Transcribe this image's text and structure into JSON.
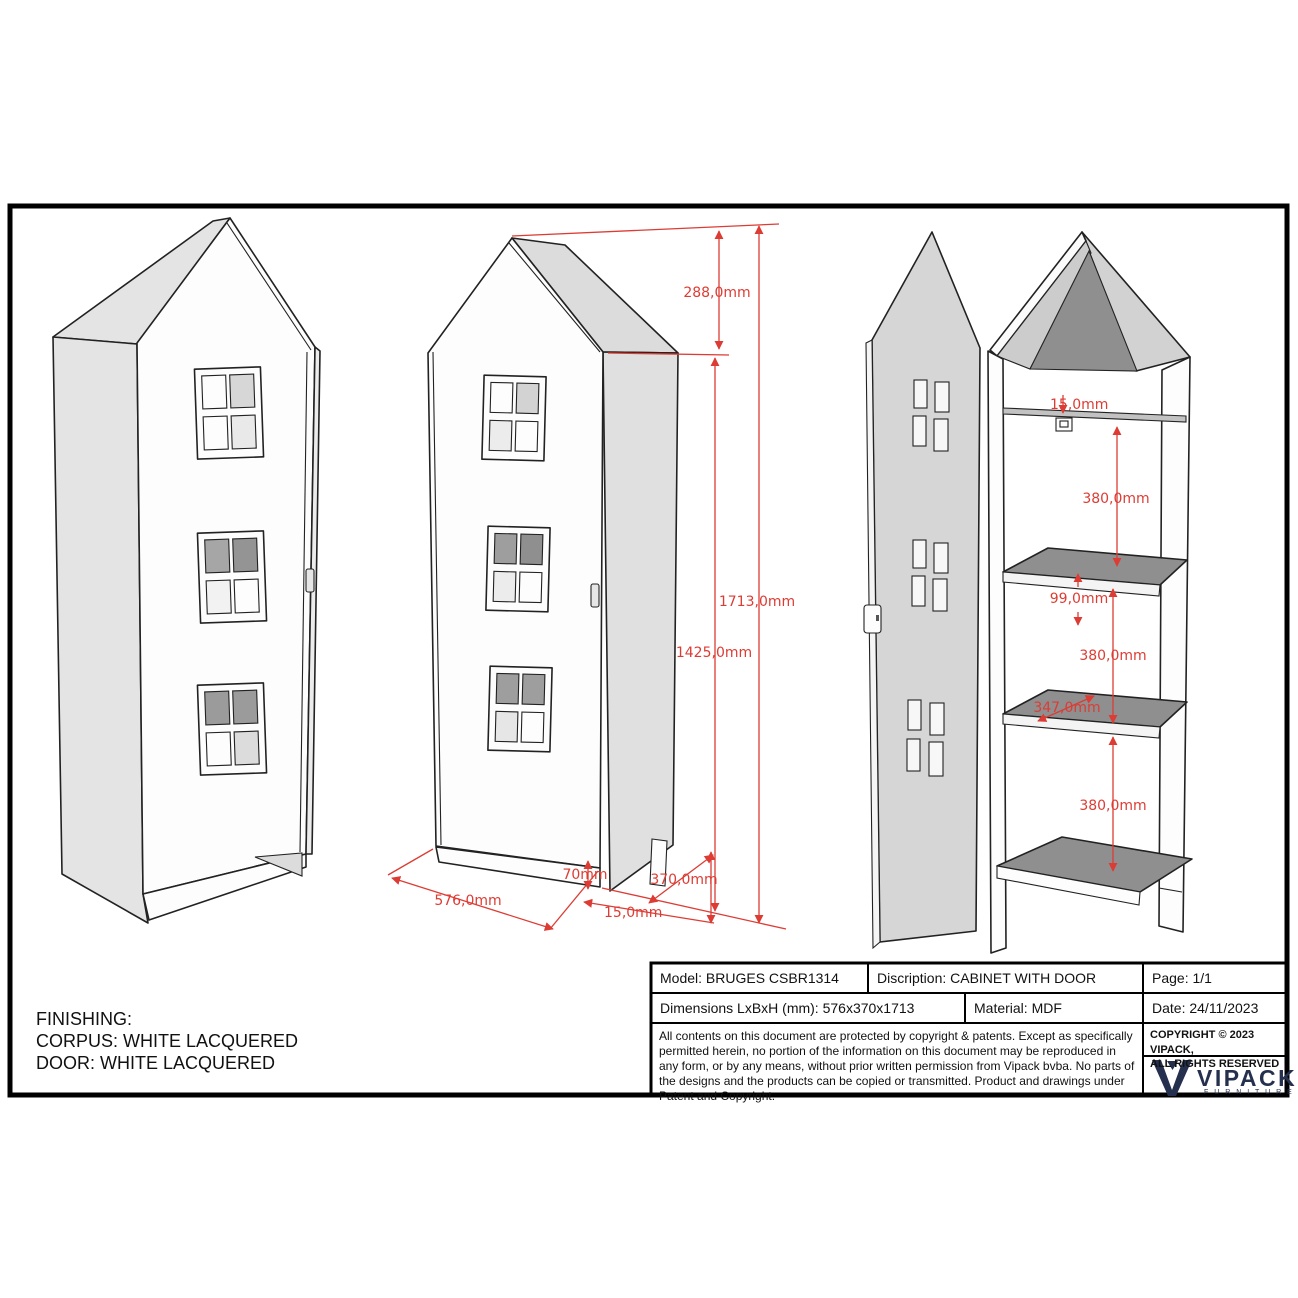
{
  "finishing": {
    "line1": "FINISHING:",
    "line2": "CORPUS: WHITE LACQUERED",
    "line3": "DOOR: WHITE LACQUERED"
  },
  "title_block": {
    "model": "Model: BRUGES CSBR1314",
    "description": "Discription: CABINET WITH DOOR",
    "page": "Page: 1/1",
    "dimensions": "Dimensions LxBxH (mm): 576x370x1713",
    "material": "Material: MDF",
    "date": "Date: 24/11/2023",
    "copyright_paragraph": "All contents on this document are protected by copyright & patents. Except as specifically permitted herein, no portion of the information on this document may be reproduced in any form, or by any means, without prior written permission from Vipack bvba. No parts of the designs and the products can be copied or transmitted. Product and drawings under Patent and Copyright.",
    "copyright_notice": "COPYRIGHT  © 2023 VIPACK,\nALL RIGHTS RESERVED",
    "brand": "VIPACK",
    "brand_sub": "F U R N I T U R E"
  },
  "dims": {
    "roof_height": "288,0mm",
    "total_height": "1713,0mm",
    "body_height": "1425,0mm",
    "width": "576,0mm",
    "plinth_height": "70mm",
    "bottom_gap": "15,0mm",
    "depth": "370,0mm",
    "top_panel": "15,0mm",
    "space_1": "380,0mm",
    "back_gap": "99,0mm",
    "space_2": "380,0mm",
    "shelf_depth": "347,0mm",
    "space_3": "380,0mm"
  },
  "colors": {
    "dimension_red": "#dd3c34",
    "brand_navy": "#25304f",
    "panel_gray": "#e4e4e4",
    "shelf_gray": "#8f8f8f",
    "line_black": "#222222"
  }
}
